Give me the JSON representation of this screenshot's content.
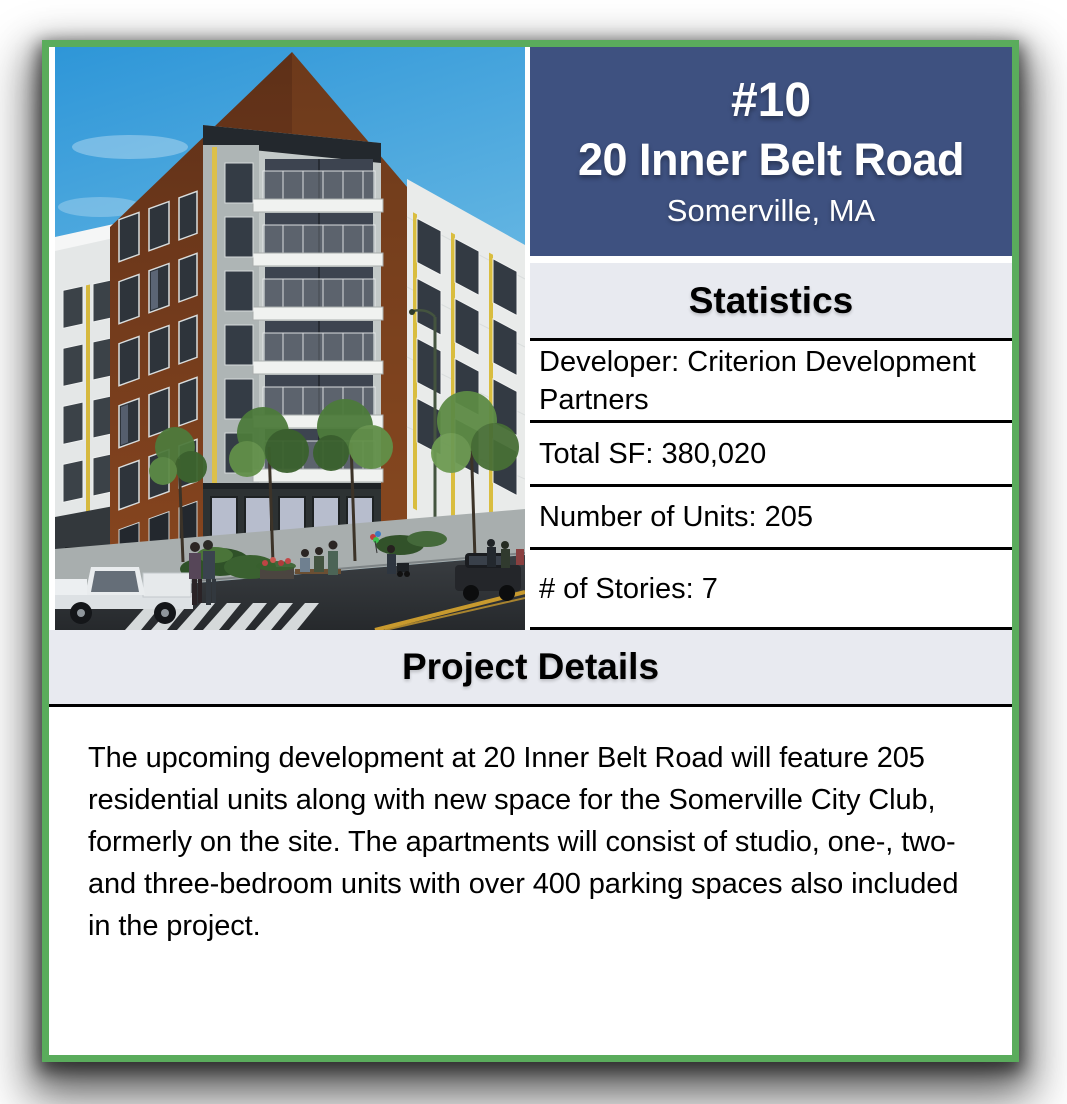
{
  "colors": {
    "border_green": "#5aac5c",
    "header_blue": "#3e5180",
    "section_gray": "#e8eaf0",
    "row_border_black": "#000000",
    "text_white": "#ffffff"
  },
  "header": {
    "rank": "#10",
    "title": "20 Inner Belt Road",
    "location": "Somerville, MA"
  },
  "statistics": {
    "heading": "Statistics",
    "rows": [
      "Developer: Criterion Development Partners",
      "Total SF: 380,020",
      "Number of Units: 205",
      "# of Stories: 7"
    ]
  },
  "project_details": {
    "heading": "Project Details",
    "body": "The upcoming development at 20 Inner Belt Road will feature 205 residential units along with new space for the Somerville City Club, formerly on the site. The apartments will consist of studio, one-, two- and three-bedroom units with over 400 parking spaces also included in the project."
  },
  "image": {
    "alt": "Architectural rendering of the 20 Inner Belt Road apartment building: a seven-story brick and white-sided corner building with stacked balconies, ground-floor storefronts, street trees, pedestrians, a white pickup truck and a dark SUV on the street"
  }
}
